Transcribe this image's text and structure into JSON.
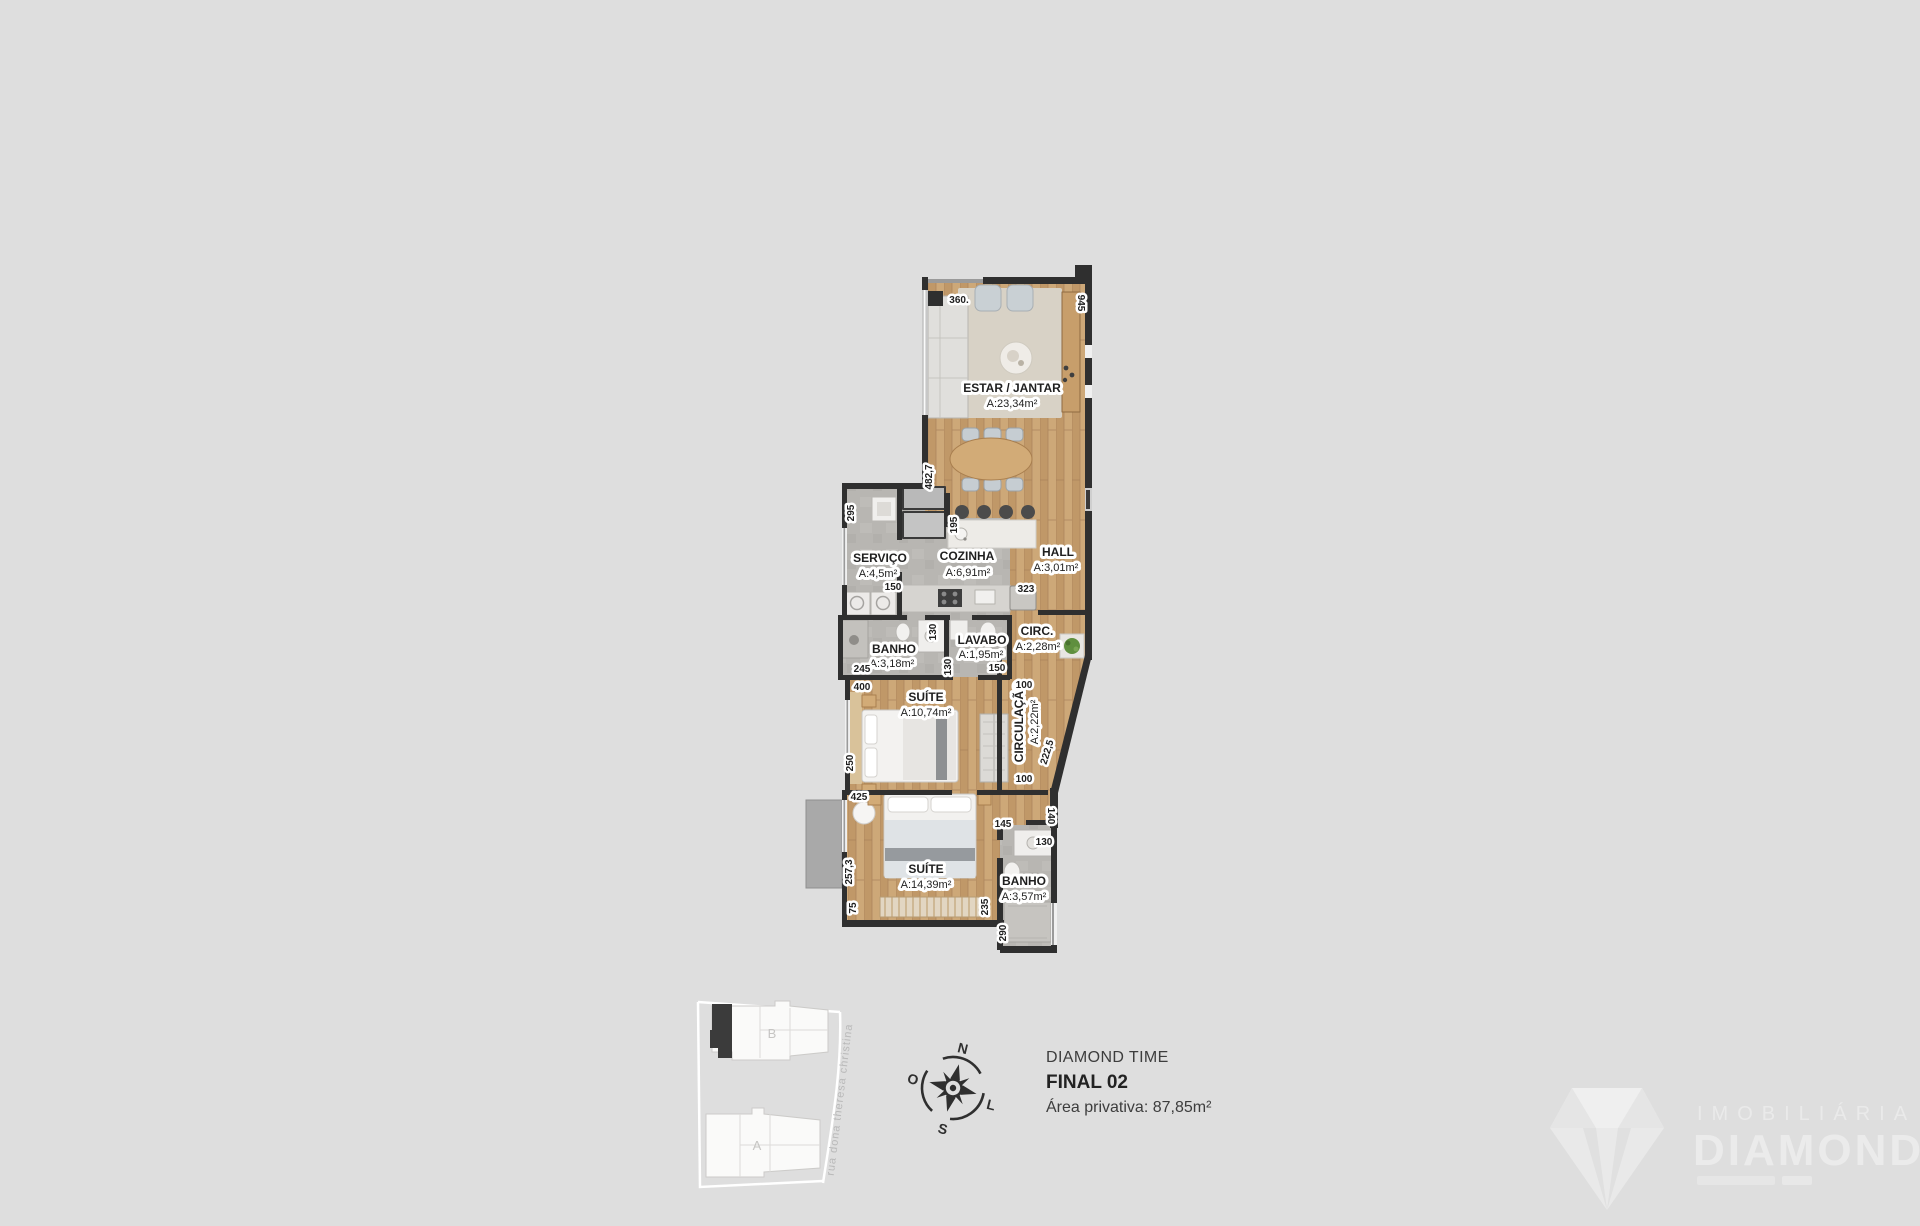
{
  "background": "#dedede",
  "plan": {
    "wall_color": "#2f2f2f",
    "rooms": [
      {
        "name": "ESTAR / JANTAR",
        "area": "A:23,34m²"
      },
      {
        "name": "SERVIÇO",
        "area": "A:4,5m²"
      },
      {
        "name": "COZINHA",
        "area": "A:6,91m²"
      },
      {
        "name": "HALL",
        "area": "A:3,01m²"
      },
      {
        "name": "BANHO",
        "area": "A:3,18m²"
      },
      {
        "name": "LAVABO",
        "area": "A:1,95m²"
      },
      {
        "name": "CIRC.",
        "area": "A:2,28m²"
      },
      {
        "name": "SUÍTE",
        "area": "A:10,74m²"
      },
      {
        "name": "CIRCULAÇÃO",
        "area": "A:2,22m²"
      },
      {
        "name": "SUÍTE",
        "area": "A:14,39m²"
      },
      {
        "name": "BANHO",
        "area": "A:3,57m²"
      }
    ],
    "dimensions": [
      "360.",
      "945",
      "482,7",
      "295",
      "195",
      "150",
      "323",
      "130",
      "245",
      "130",
      "150",
      "100",
      "400",
      "250",
      "100",
      "222,5",
      "425",
      "145",
      "140",
      "130",
      "257,3",
      "75",
      "235",
      "290"
    ]
  },
  "legend": {
    "project": "DIAMOND TIME",
    "unit": "FINAL 02",
    "private_area": "Área privativa: 87,85m²"
  },
  "site_key": {
    "street": "rua dona theresa christina",
    "building_a": "A",
    "building_b": "B"
  },
  "compass": {
    "north": "N",
    "south": "S",
    "west": "O",
    "east": "L"
  },
  "watermark": {
    "line1": "IMOBILIÁRIA",
    "line2": "DIAMOND"
  }
}
